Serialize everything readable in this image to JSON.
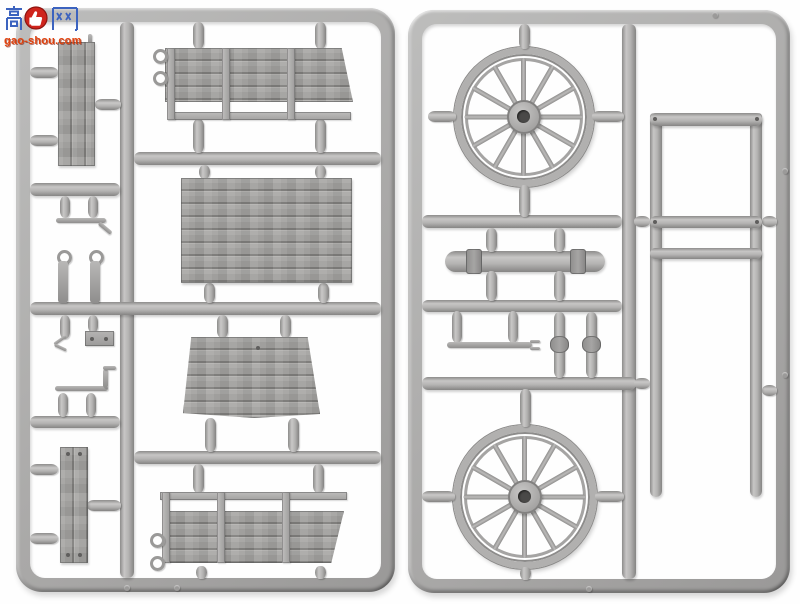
{
  "meta": {
    "type": "product-photo",
    "subject": "two grey injection-moulded plastic model sprues with horse-drawn wagon parts",
    "background_color": "#ffffff"
  },
  "watermark": {
    "site_name": "高手网",
    "visible_text_cn": "高网",
    "logo_icon": "thumbs-up-icon",
    "logo_replaces_character": "手",
    "url": "gao-shou.com",
    "cn_text_color": "#3c63bf",
    "logo_color": "#cf241c",
    "url_color": "#e2430e"
  },
  "plastic": {
    "base_color": "#b4b3b1",
    "highlight_color": "#c9c8c7",
    "shadow_color": "#868584",
    "wood_grain_color": "#7f7e7c"
  },
  "sprues": [
    {
      "id": "A",
      "side": "left",
      "parts": [
        {
          "name": "side-door-panel",
          "desc": "tall panel of 2 vertical planks with latch pin on top"
        },
        {
          "name": "upper-side-panel",
          "desc": "long wagon side, 4 plank rows, 3 battens, separate bottom rail, 2 tie-down eyelets, angled right end"
        },
        {
          "name": "cargo-floor",
          "desc": "rectangular floor of 8 horizontal planks with wood grain"
        },
        {
          "name": "front-board",
          "desc": "flared planked front board with curved lower edge and small peg hole"
        },
        {
          "name": "narrow-plank-panel",
          "desc": "small panel of 2 vertical planks with rivets"
        },
        {
          "name": "lower-side-panel",
          "desc": "long wagon side (mirror of upper), top rail gap, 2 eyelets, angled right end"
        },
        {
          "name": "step-bracket",
          "desc": "thin footboard bracket with bent end"
        },
        {
          "name": "ring-pin",
          "count": 2,
          "desc": "pins with round eye on top"
        },
        {
          "name": "forked-hook",
          "desc": "small two-prong hook"
        },
        {
          "name": "bolt-plate",
          "desc": "small plate with 2 bolt holes"
        },
        {
          "name": "footboard-rod",
          "desc": "thin bracket rod with raised bent tip"
        }
      ]
    },
    {
      "id": "B",
      "side": "right",
      "parts": [
        {
          "name": "spoked-wheel-upper",
          "spokes": 12,
          "desc": "large wooden cart wheel, double rim, round hub with centre hole"
        },
        {
          "name": "spoked-wheel-lower",
          "spokes": 12,
          "desc": "large wooden cart wheel, double rim, round hub with centre hole"
        },
        {
          "name": "axle-beam",
          "desc": "round-ended axle beam with two strap bands"
        },
        {
          "name": "side-rack-frame",
          "desc": "tall rack frame: 2 rails and 3 crossbars with rivet holes"
        },
        {
          "name": "tie-rod",
          "desc": "thin rod with forked end"
        },
        {
          "name": "bolt-pin",
          "count": 2,
          "desc": "short pins with centre collar"
        }
      ]
    }
  ]
}
